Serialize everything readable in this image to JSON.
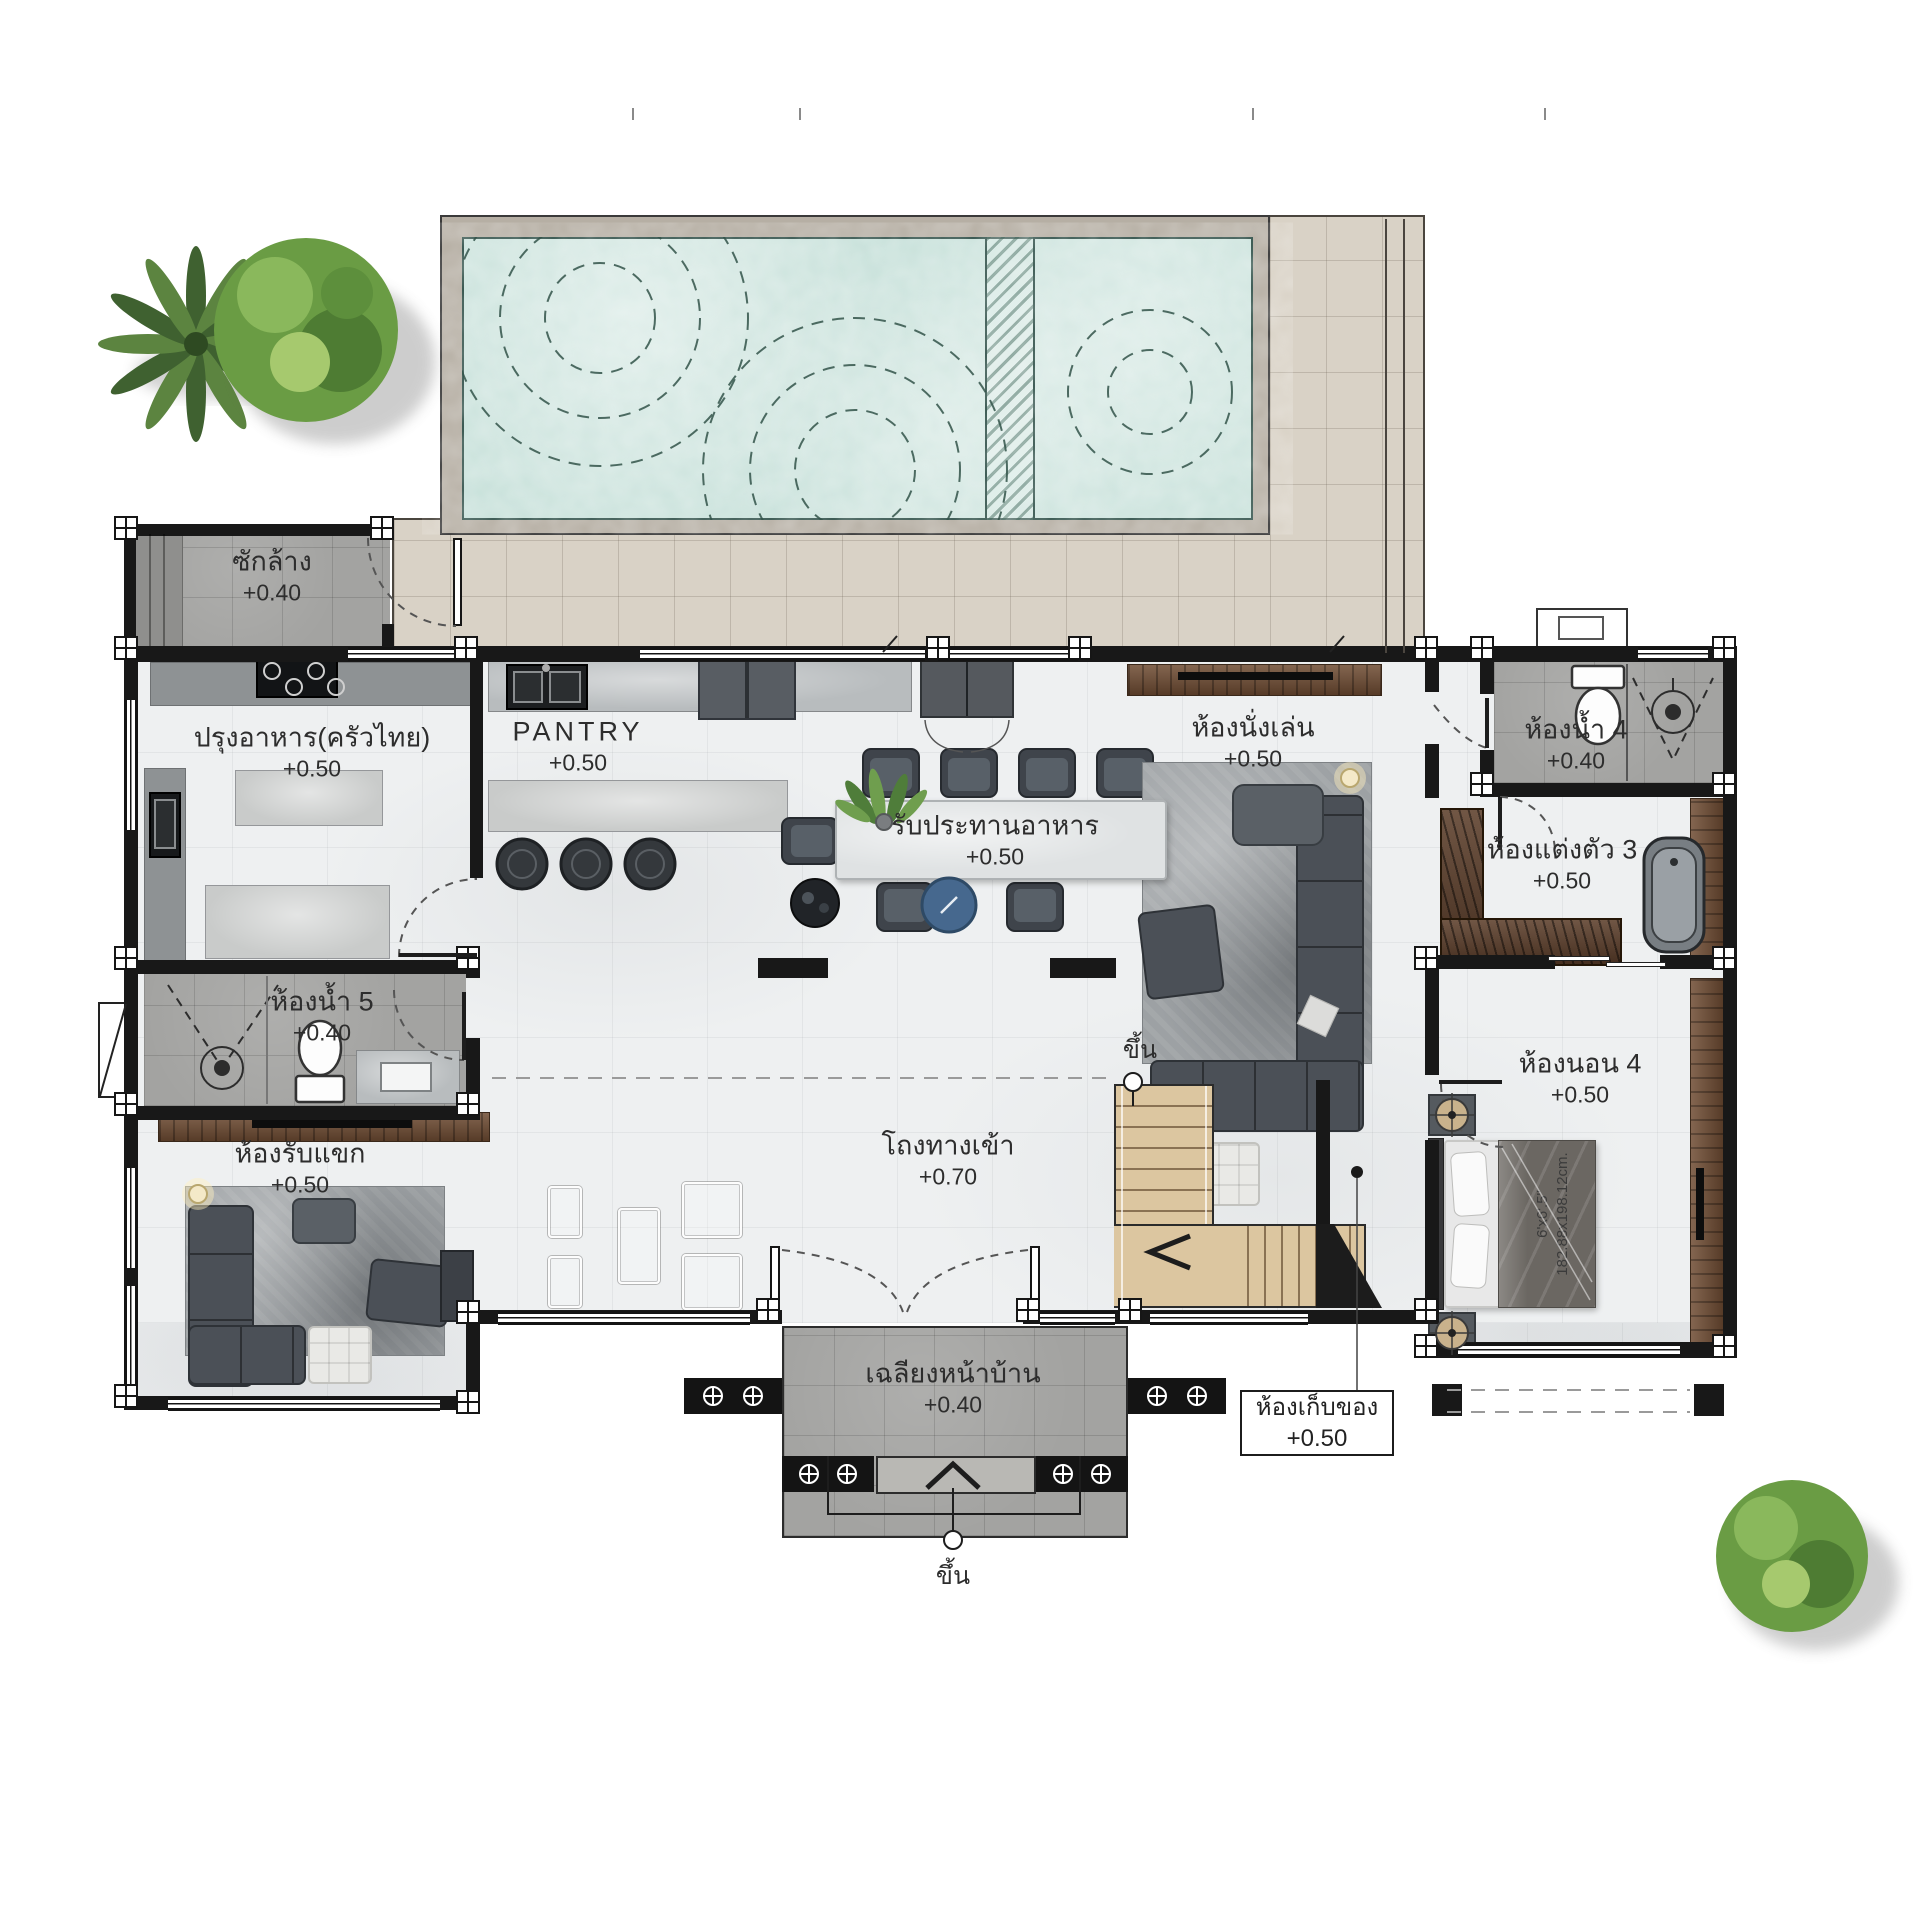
{
  "plan": {
    "rooms": [
      {
        "key": "laundry",
        "name": "ซักล้าง",
        "elevation": "+0.40"
      },
      {
        "key": "thai-kitchen",
        "name": "ปรุงอาหาร(ครัวไทย)",
        "elevation": "+0.50"
      },
      {
        "key": "pantry",
        "name": "PANTRY",
        "elevation": "+0.50"
      },
      {
        "key": "dining",
        "name": "รับประทานอาหาร",
        "elevation": "+0.50"
      },
      {
        "key": "living",
        "name": "ห้องนั่งเล่น",
        "elevation": "+0.50"
      },
      {
        "key": "bathroom-4",
        "name": "ห้องน้ำ 4",
        "elevation": "+0.40"
      },
      {
        "key": "dressing-3",
        "name": "ห้องแต่งตัว 3",
        "elevation": "+0.50"
      },
      {
        "key": "bedroom-4",
        "name": "ห้องนอน 4",
        "elevation": "+0.50"
      },
      {
        "key": "bathroom-5",
        "name": "ห้องน้ำ 5",
        "elevation": "+0.40"
      },
      {
        "key": "guest",
        "name": "ห้องรับแขก",
        "elevation": "+0.50"
      },
      {
        "key": "entry-hall",
        "name": "โถงทางเข้า",
        "elevation": "+0.70"
      },
      {
        "key": "front-porch",
        "name": "เฉลียงหน้าบ้าน",
        "elevation": "+0.40"
      },
      {
        "key": "storage",
        "name": "ห้องเก็บของ",
        "elevation": "+0.50"
      }
    ],
    "stairs": {
      "up_label": "ขึ้น"
    },
    "porch_entry": {
      "up_label": "ขึ้น"
    },
    "bed": {
      "size_line1": "6'x6'.5\"",
      "size_line2": "182.88x198.12cm."
    },
    "colors": {
      "pool_water": "#c6e0d9",
      "deck_tile": "#d9d2c6",
      "wet_area_tile": "#a3a3a1",
      "marble_floor": "#eef0f1",
      "wall": "#181818",
      "wood": "#6f4c33",
      "stair_wood": "#dcc6a0",
      "accent_round_table": "#46688e",
      "sofa": "#4b5057",
      "tree": "#6a9c44"
    }
  }
}
